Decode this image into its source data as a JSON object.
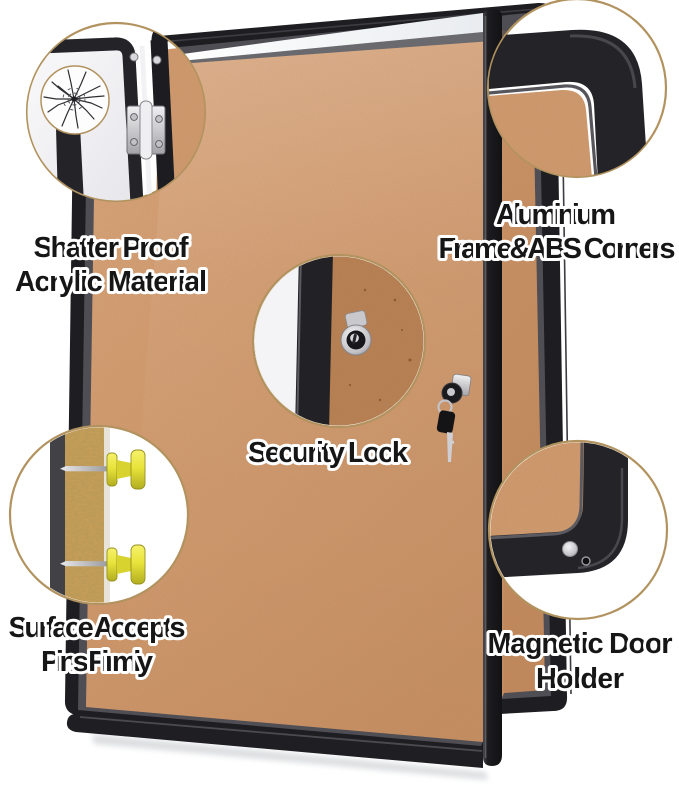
{
  "features": [
    {
      "id": "shatter-proof-acrylic",
      "line1": "Shatter Proof",
      "line2": "Acrylic Material"
    },
    {
      "id": "aluminium-frame-abs-corners",
      "line1": "Aluminium",
      "line2": "Frame&ABS Corners"
    },
    {
      "id": "security-lock",
      "line1": "Security Lock"
    },
    {
      "id": "pin-friendly-surface",
      "line1": "Surface Accepts",
      "line2": "Pins Firmly"
    },
    {
      "id": "magnetic-door-holder",
      "line1": "Magnetic Door",
      "line2": "Holder"
    }
  ],
  "callouts": [
    {
      "name": "hinge-and-cracked-acrylic-detail"
    },
    {
      "name": "rounded-abs-corner-detail"
    },
    {
      "name": "security-lock-detail"
    },
    {
      "name": "push-pins-in-cork-detail"
    },
    {
      "name": "magnetic-door-holder-detail"
    }
  ],
  "colors": {
    "background": "#ffffff",
    "cork": "#d29a6e",
    "cork_dark": "#b87e51",
    "cork_section": "#c89e58",
    "frame_black": "#1e1e22",
    "groove_gray": "#4e4e54",
    "callout_ring": "#b2935f",
    "pin_yellow": "#e9e43b",
    "pin_yellow_dark": "#d8d32e",
    "metal_silver": "#cfcfd3",
    "text": "#161616",
    "text_outline": "#ffffff"
  }
}
